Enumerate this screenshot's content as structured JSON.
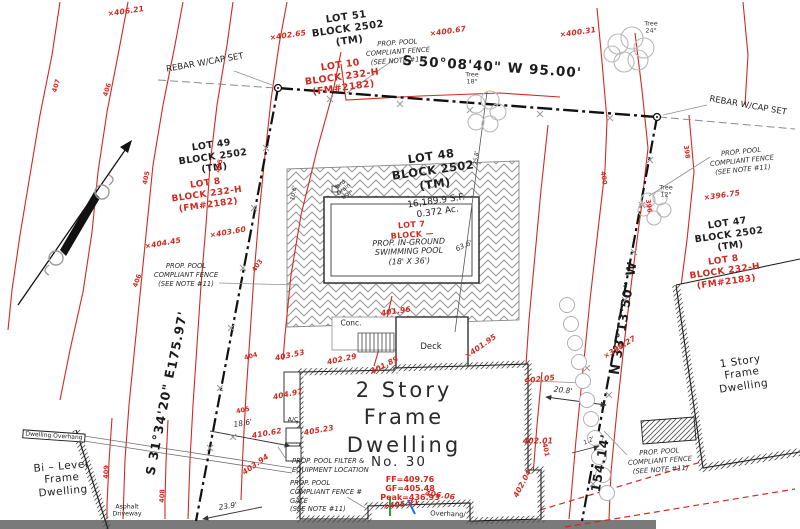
{
  "colors": {
    "contour_red": "#d02a20",
    "ink_black": "#1f1f1f",
    "leader_gray": "#909090",
    "tree_gray": "#b8b8b8",
    "page_edge_gray": "#7a7a7a",
    "tick_green": "#2e9e3e",
    "tick_blue": "#2f6fd0"
  },
  "boundary": {
    "north": "S 50°08'40\" W  95.00'",
    "west_bearing": "S 31°34'20\" E",
    "west_distance": "175.97'",
    "east_bearing": "N 33°13'50\" W",
    "east_distance": "154.14'",
    "monument_left": "REBAR W/CAP SET",
    "monument_right": "REBAR W/CAP SET"
  },
  "lots": {
    "lot51": [
      "LOT 51",
      "BLOCK 2502",
      "(TM)"
    ],
    "lot10": [
      "LOT 10",
      "BLOCK 232-H",
      "(FM#2182)"
    ],
    "lot49": [
      "LOT 49",
      "BLOCK 2502",
      "(TM)"
    ],
    "lot8a": [
      "LOT 8",
      "BLOCK 232-H",
      "(FM#2182)"
    ],
    "lot48": [
      "LOT 48",
      "BLOCK 2502",
      "(TM)"
    ],
    "lot48_area": [
      "16,189.9 S.F.",
      "0.372 Ac."
    ],
    "lot7": [
      "LOT 7",
      "BLOCK —"
    ],
    "lot47": [
      "LOT 47",
      "BLOCK 2502",
      "(TM)"
    ],
    "lot8b": [
      "LOT 8",
      "BLOCK 232-H",
      "(FM#2183)"
    ]
  },
  "pool_label": [
    "PROP. IN-GROUND",
    "SWIMMING POOL",
    "(18' X 36')"
  ],
  "notes": {
    "fence": [
      "PROP. POOL",
      "COMPLIANT FENCE",
      "(SEE NOTE #11)"
    ],
    "fence_gate": [
      "PROP. POOL",
      "COMPLIANT FENCE #",
      "GATE",
      "(SEE NOTE #11)"
    ],
    "filter": [
      "PROP. POOL FILTER &",
      "EQUIPMENT LOCATION"
    ]
  },
  "dwellings": {
    "main": [
      "2 Story",
      "Frame",
      "Dwelling"
    ],
    "main_no": "No. 30",
    "main_elev": [
      "FF=409.76",
      "GF=405.48",
      "Peak=436.93"
    ],
    "one_story": [
      "1 Story",
      "Frame",
      "Dwelling"
    ],
    "bi_level": [
      "Bi – Level",
      "Frame",
      "Dwelling"
    ],
    "overhang_box": "Dwelling Overhang",
    "overhang": "Overhang/",
    "asphalt": [
      "Asphalt",
      "Driveway"
    ]
  },
  "site": {
    "conc": "Conc.",
    "deck": "Deck",
    "ac": "A/C",
    "yard_drain": [
      "Yard",
      "Drain",
      "t/g="
    ],
    "tree18": [
      "Tree",
      "18\""
    ],
    "tree24": [
      "Tree",
      "24\""
    ],
    "tree12": [
      "Tree",
      "12\""
    ]
  },
  "dims": {
    "d95_included_in_bearing": "",
    "d63": "63.6'",
    "d25": "25.8'",
    "d20": "20.8'",
    "d18": "18.6'",
    "d23": "23.9'",
    "d1": "1.2'",
    "d10": "10.6'"
  },
  "spots": {
    "s406_21": "×406.21",
    "s402_65": "×402.65",
    "s400_67": "×400.67",
    "s400_31": "×400.31",
    "s403_60": "×403.60",
    "s404_45": "×404.45",
    "s396_75": "×396.75",
    "s398_27": "×398.27",
    "s401_96": "401.96",
    "s401_95": "×401.95",
    "s401_89": "401.89",
    "s402_29": "402.29",
    "s403_53": "403.53",
    "s404_97": "404.97",
    "s405_23": "405.23",
    "s410_62": "410.62",
    "s403_94": "403.94",
    "s402_05": "402.05",
    "s402_01": "402.01",
    "s402_04": "402.04",
    "s405_71": "×405.71",
    "s406_06": "406.06"
  },
  "contours": [
    "407",
    "406",
    "405",
    "405",
    "406",
    "403",
    "404",
    "405",
    "409",
    "408",
    "400",
    "398",
    "396",
    "401"
  ]
}
